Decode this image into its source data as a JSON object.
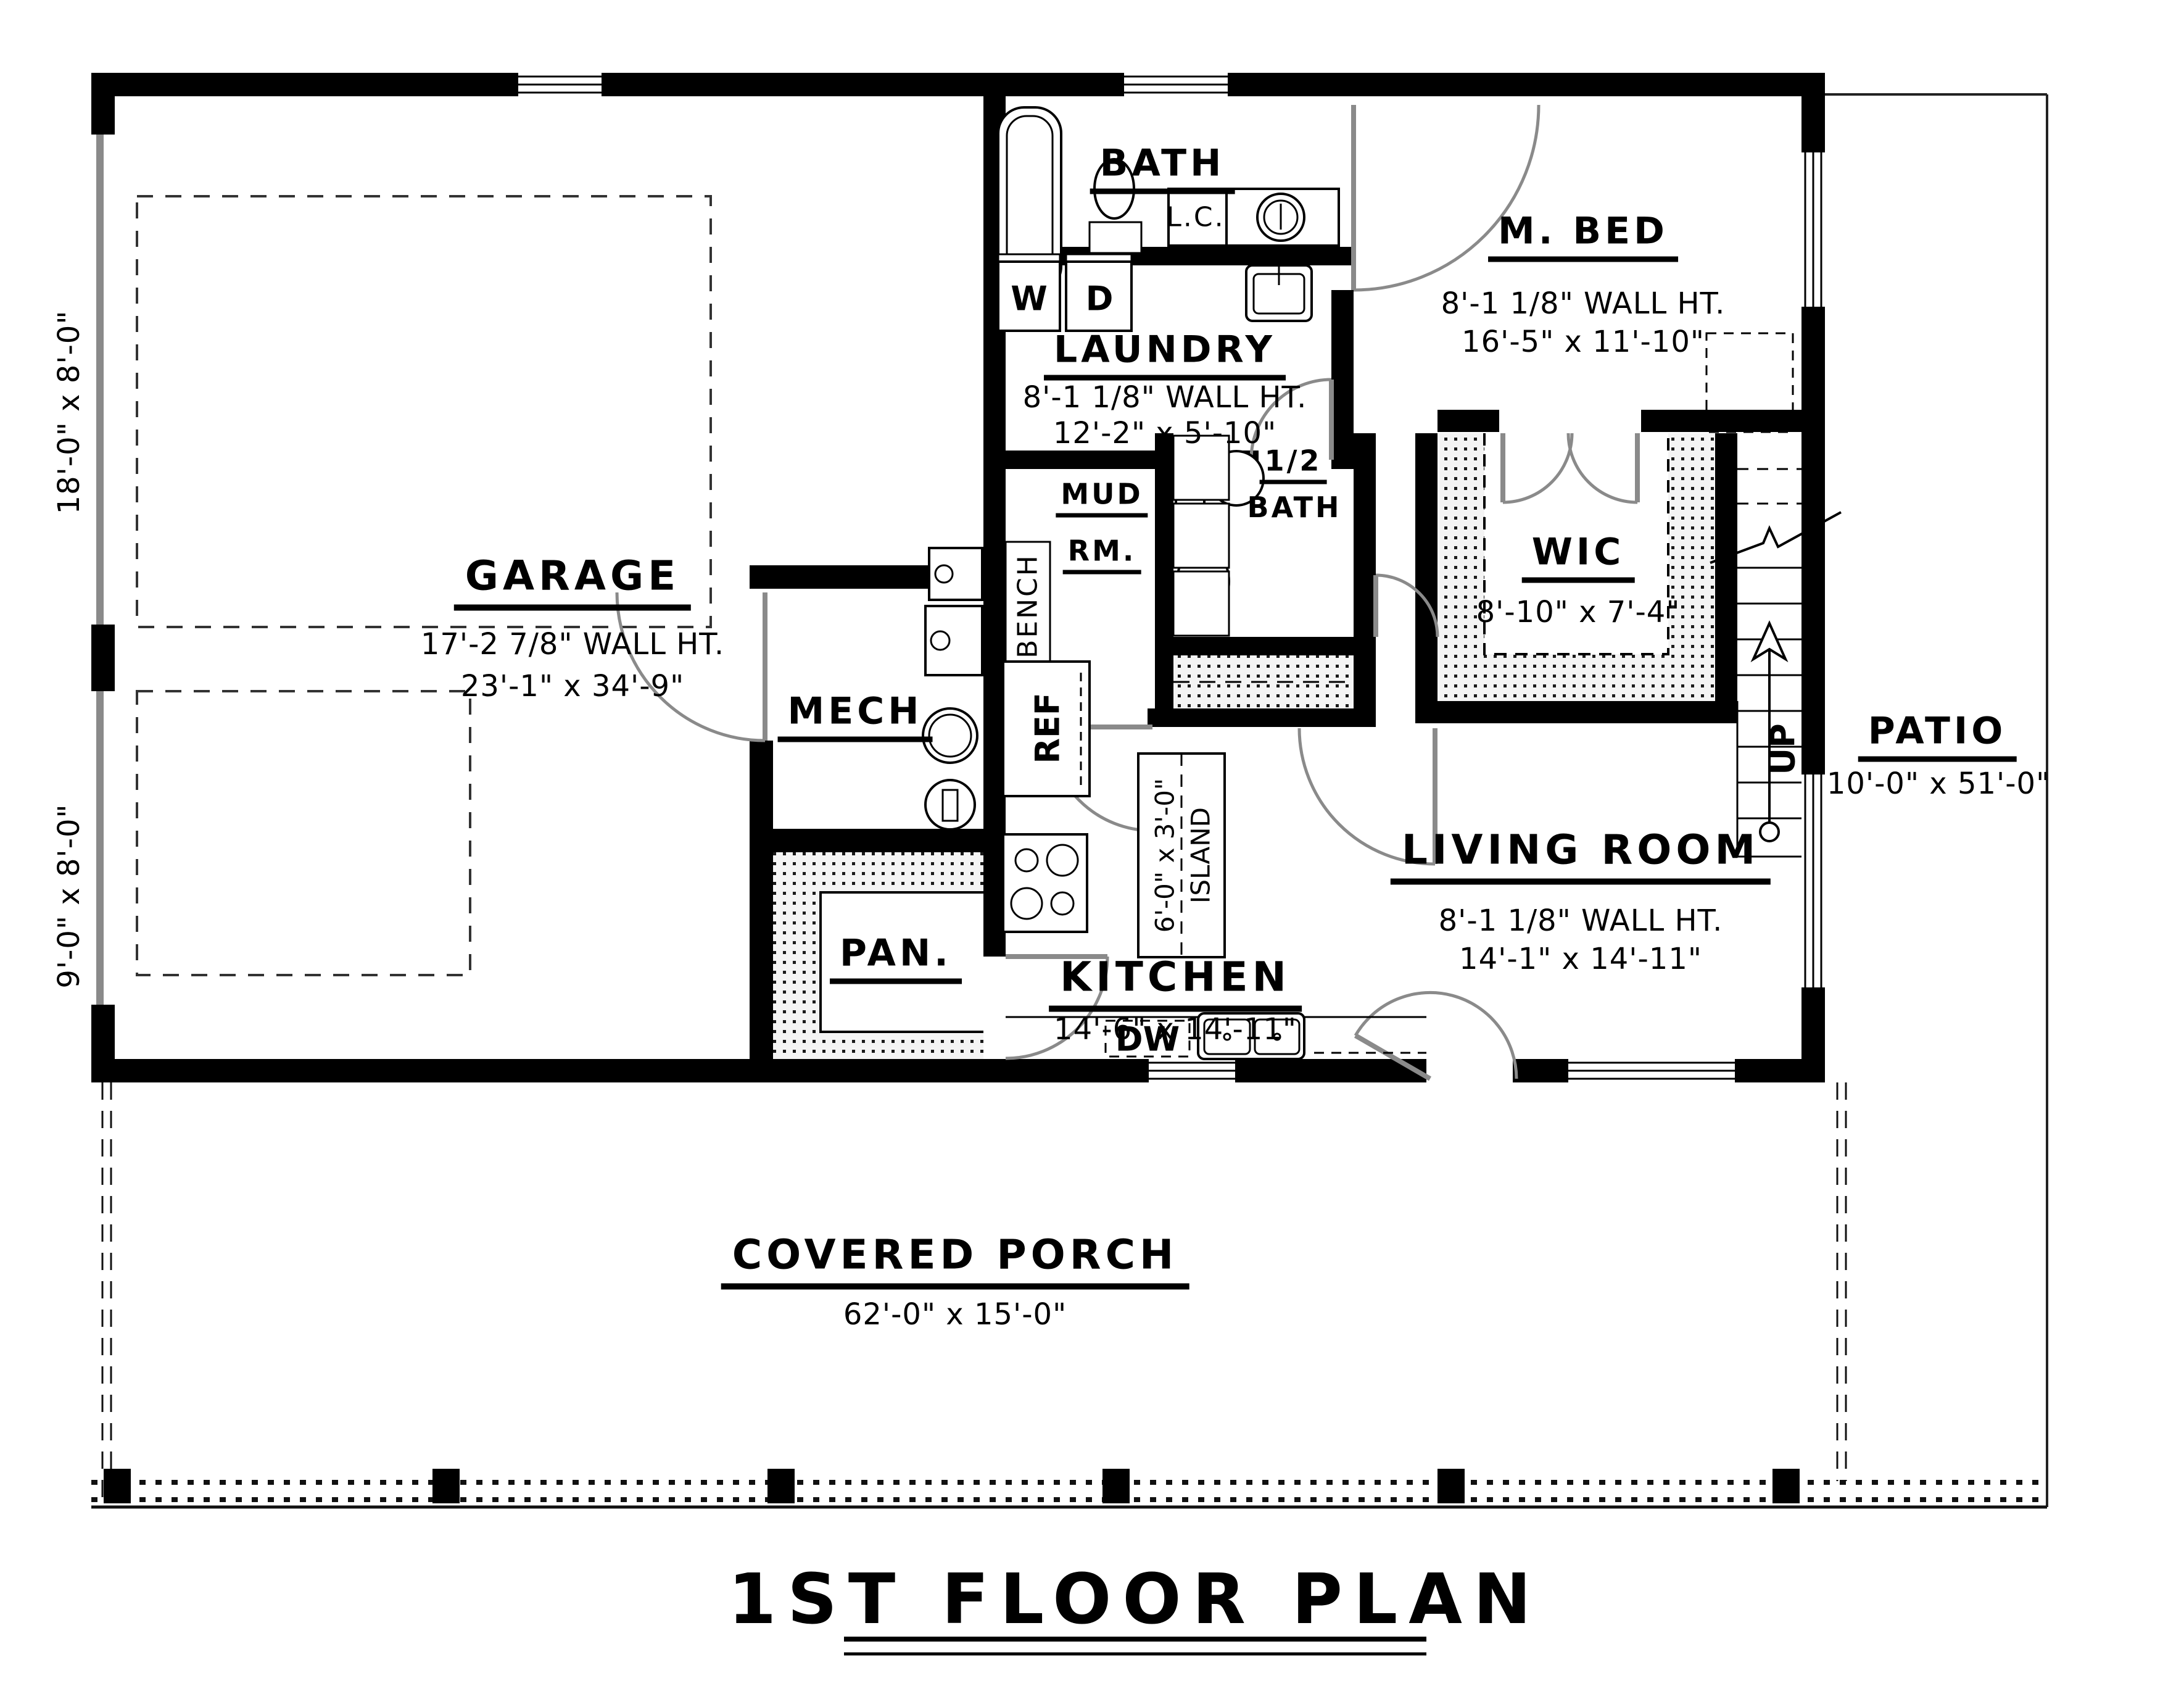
{
  "title": "1ST FLOOR PLAN",
  "rooms": {
    "bath": {
      "name": "BATH"
    },
    "mbed": {
      "name": "M. BED",
      "wall": "8'-1 1/8\" WALL HT.",
      "dims": "16'-5\" x 11'-10\""
    },
    "laundry": {
      "name": "LAUNDRY",
      "wall": "8'-1 1/8\" WALL HT.",
      "dims": "12'-2\" x 5'-10\""
    },
    "mud": {
      "line1": "MUD",
      "line2": "RM."
    },
    "half_bath": {
      "line1": "1/2",
      "line2": "BATH"
    },
    "wic": {
      "name": "WIC",
      "dims": "8'-10\" x 7'-4\""
    },
    "garage": {
      "name": "GARAGE",
      "wall": "17'-2 7/8\" WALL HT.",
      "dims": "23'-1\" x 34'-9\""
    },
    "mech": {
      "name": "MECH"
    },
    "pan": {
      "name": "PAN."
    },
    "kitchen": {
      "name": "KITCHEN",
      "dims": "14'-6\" x 14'-11\""
    },
    "living": {
      "name": "LIVING ROOM",
      "wall": "8'-1 1/8\" WALL HT.",
      "dims": "14'-1\" x 14'-11\""
    },
    "patio": {
      "name": "PATIO",
      "dims": "10'-0\" x 51'-0\""
    },
    "porch": {
      "name": "COVERED PORCH",
      "dims": "62'-0\" x 15'-0\""
    }
  },
  "fixtures": {
    "washer": "W",
    "dryer": "D",
    "linen_cabinet": "L.C.",
    "bench": "BENCH",
    "fridge": "REF",
    "dishwasher": "DW",
    "stairs_up": "UP",
    "island_dims": "6'-0\" x 3'-0\"",
    "island_label": "ISLAND"
  },
  "garage_doors": {
    "door_large": "18'-0\" x 8'-0\"",
    "door_small": "9'-0\" x 8'-0\""
  },
  "colors": {
    "wall": "#000000",
    "door_swing": "#8a8a8a",
    "hatch_dot": "#1a1a1a"
  }
}
